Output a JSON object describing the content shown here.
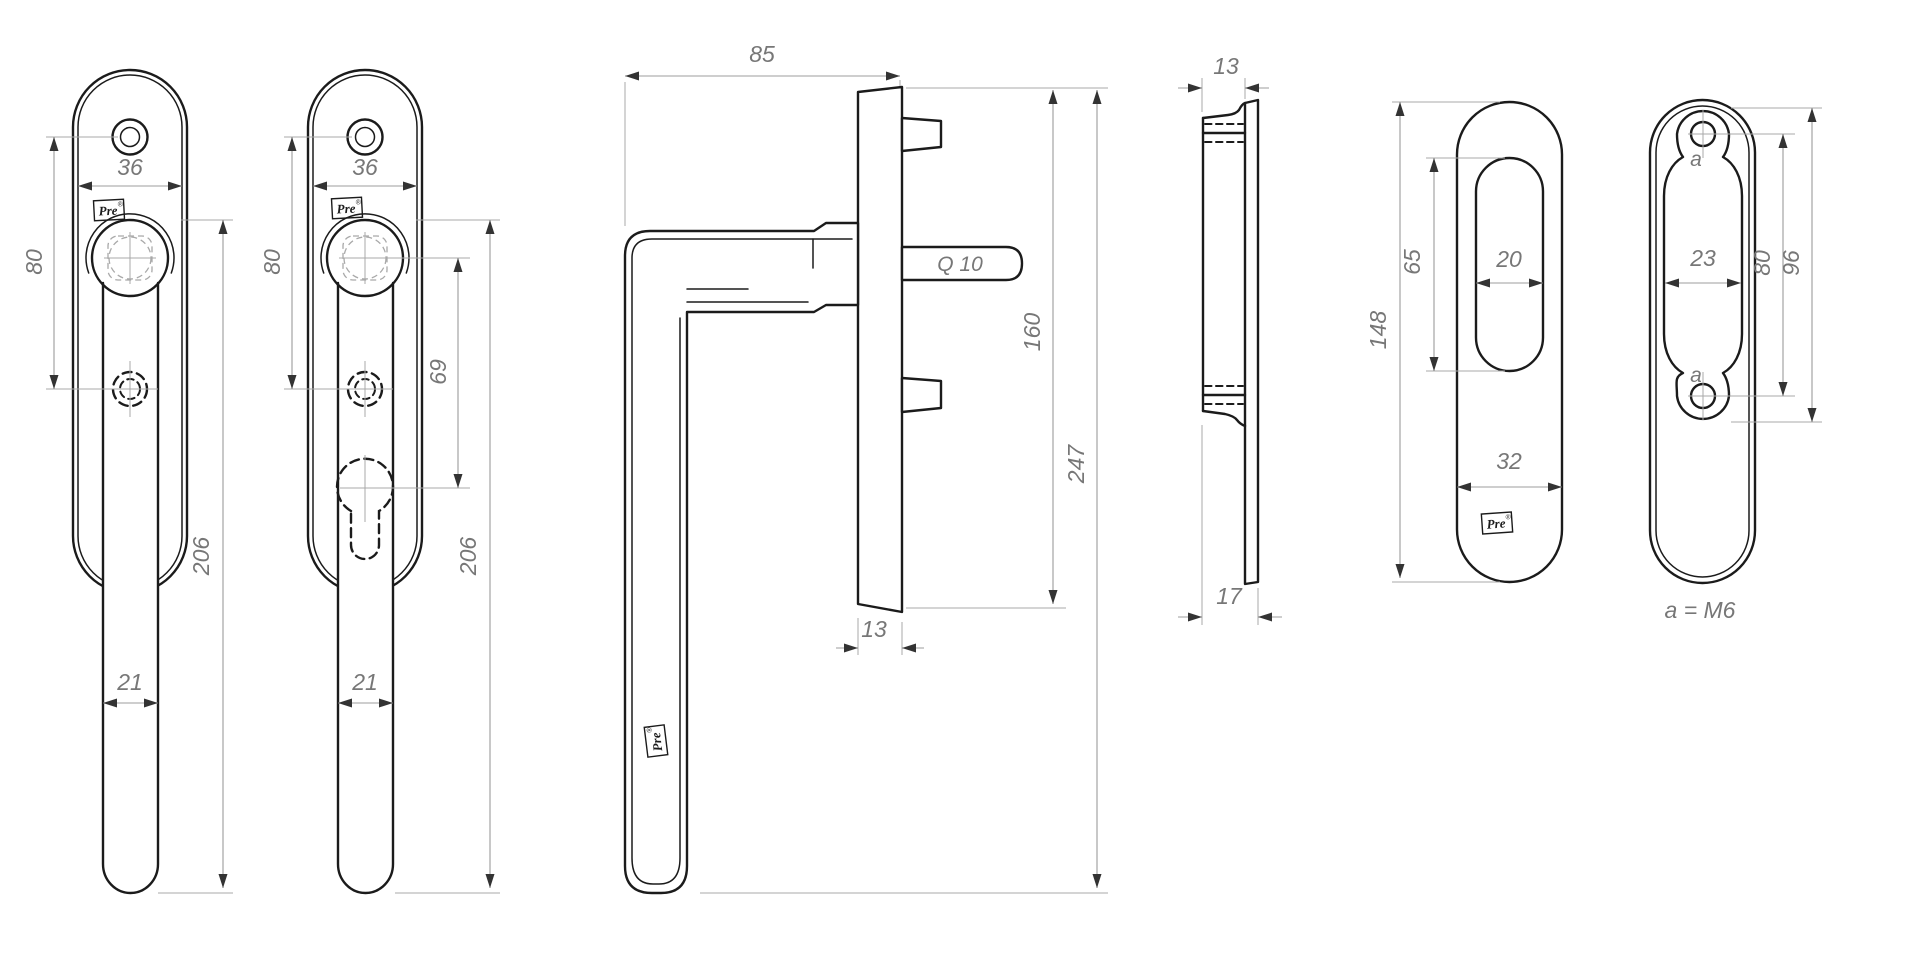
{
  "drawing": {
    "colors": {
      "background": "#ffffff",
      "contour": "#1b1b1b",
      "dimension": "#9c9c9c",
      "arrow": "#333333",
      "text": "#777777"
    },
    "logo": {
      "text": "Pre",
      "mark": "®"
    },
    "views": {
      "handle_front_plain": {
        "dims": {
          "plate_width": "36",
          "hole_spacing": "80",
          "length": "206",
          "lever_width": "21"
        }
      },
      "handle_front_cylinder": {
        "dims": {
          "plate_width": "36",
          "hole_spacing": "80",
          "cylinder_offset": "69",
          "length": "206",
          "lever_width": "21"
        }
      },
      "handle_side": {
        "dims": {
          "depth": "85",
          "spindle": "Q 10",
          "plate_height": "160",
          "total_height": "247",
          "plate_width": "13"
        }
      },
      "plate_profile": {
        "dims": {
          "thickness": "13",
          "thickness_total": "17"
        }
      },
      "plate_front": {
        "dims": {
          "height": "148",
          "slot_height": "65",
          "slot_width": "20",
          "width": "32"
        }
      },
      "plate_back": {
        "dims": {
          "inner_width": "23",
          "hole_spacing": "80",
          "inner_height": "96"
        },
        "hole_label": "a",
        "note": "a = M6"
      }
    }
  }
}
